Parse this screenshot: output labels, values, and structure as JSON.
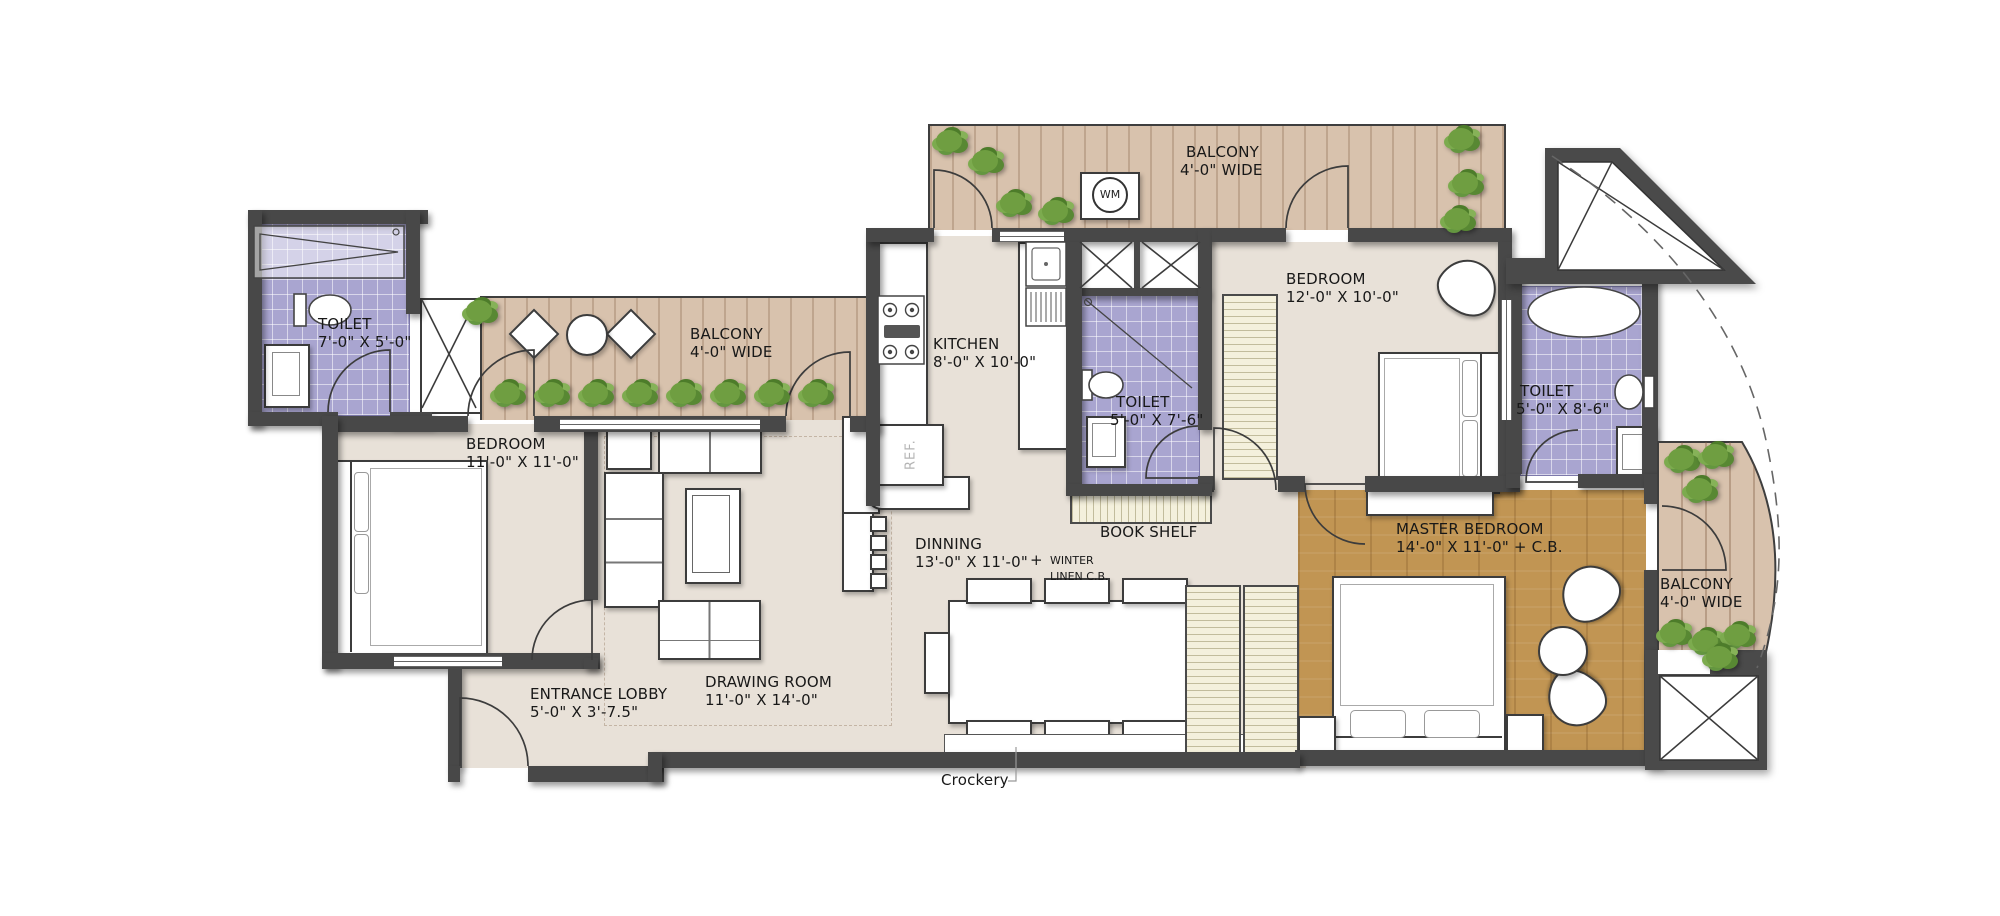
{
  "rooms": {
    "toilet_top_left": {
      "name": "TOILET",
      "dims": "7'-0\" X 5'-0\""
    },
    "bedroom_left": {
      "name": "BEDROOM",
      "dims": "11'-0\" X 11'-0\""
    },
    "balcony_left": {
      "name": "BALCONY",
      "dims": "4'-0\" WIDE"
    },
    "kitchen": {
      "name": "KITCHEN",
      "dims": "8'-0\" X 10'-0\""
    },
    "balcony_top": {
      "name": "BALCONY",
      "dims": "4'-0\" WIDE"
    },
    "toilet_center": {
      "name": "TOILET",
      "dims": "5'-0\" X 7'-6\""
    },
    "bedroom_center": {
      "name": "BEDROOM",
      "dims": "12'-0\" X 10'-0\""
    },
    "toilet_right": {
      "name": "TOILET",
      "dims": "5'-0\" X 8'-6\""
    },
    "master_bedroom": {
      "name": "MASTER BEDROOM",
      "dims": "14'-0\" X 11'-0\" + C.B."
    },
    "balcony_right": {
      "name": "BALCONY",
      "dims": "4'-0\" WIDE"
    },
    "dining": {
      "name": "DINNING",
      "dims": "13'-0\" X 11'-0\"",
      "plus": "+",
      "note_line1": "WINTER",
      "note_line2": "LINEN C.B."
    },
    "drawing_room": {
      "name": "DRAWING ROOM",
      "dims": "11'-0\" X 14'-0\""
    },
    "entrance_lobby": {
      "name": "ENTRANCE LOBBY",
      "dims": "5'-0\" X 3'-7.5\""
    }
  },
  "annotations": {
    "book_shelf": "BOOK SHELF",
    "crockery": "Crockery",
    "washing_machine": "WM",
    "refrigerator": "REF."
  },
  "palette": {
    "wall": "#484848",
    "floor": "#e8e1d8",
    "toilet_tile": "#a9a5d0",
    "deck_wood": "#d8c2ad",
    "master_wood": "#c19553",
    "cabinet_cream": "#f4f0dc",
    "plant_green": "#6f9e41",
    "background": "#ffffff"
  }
}
